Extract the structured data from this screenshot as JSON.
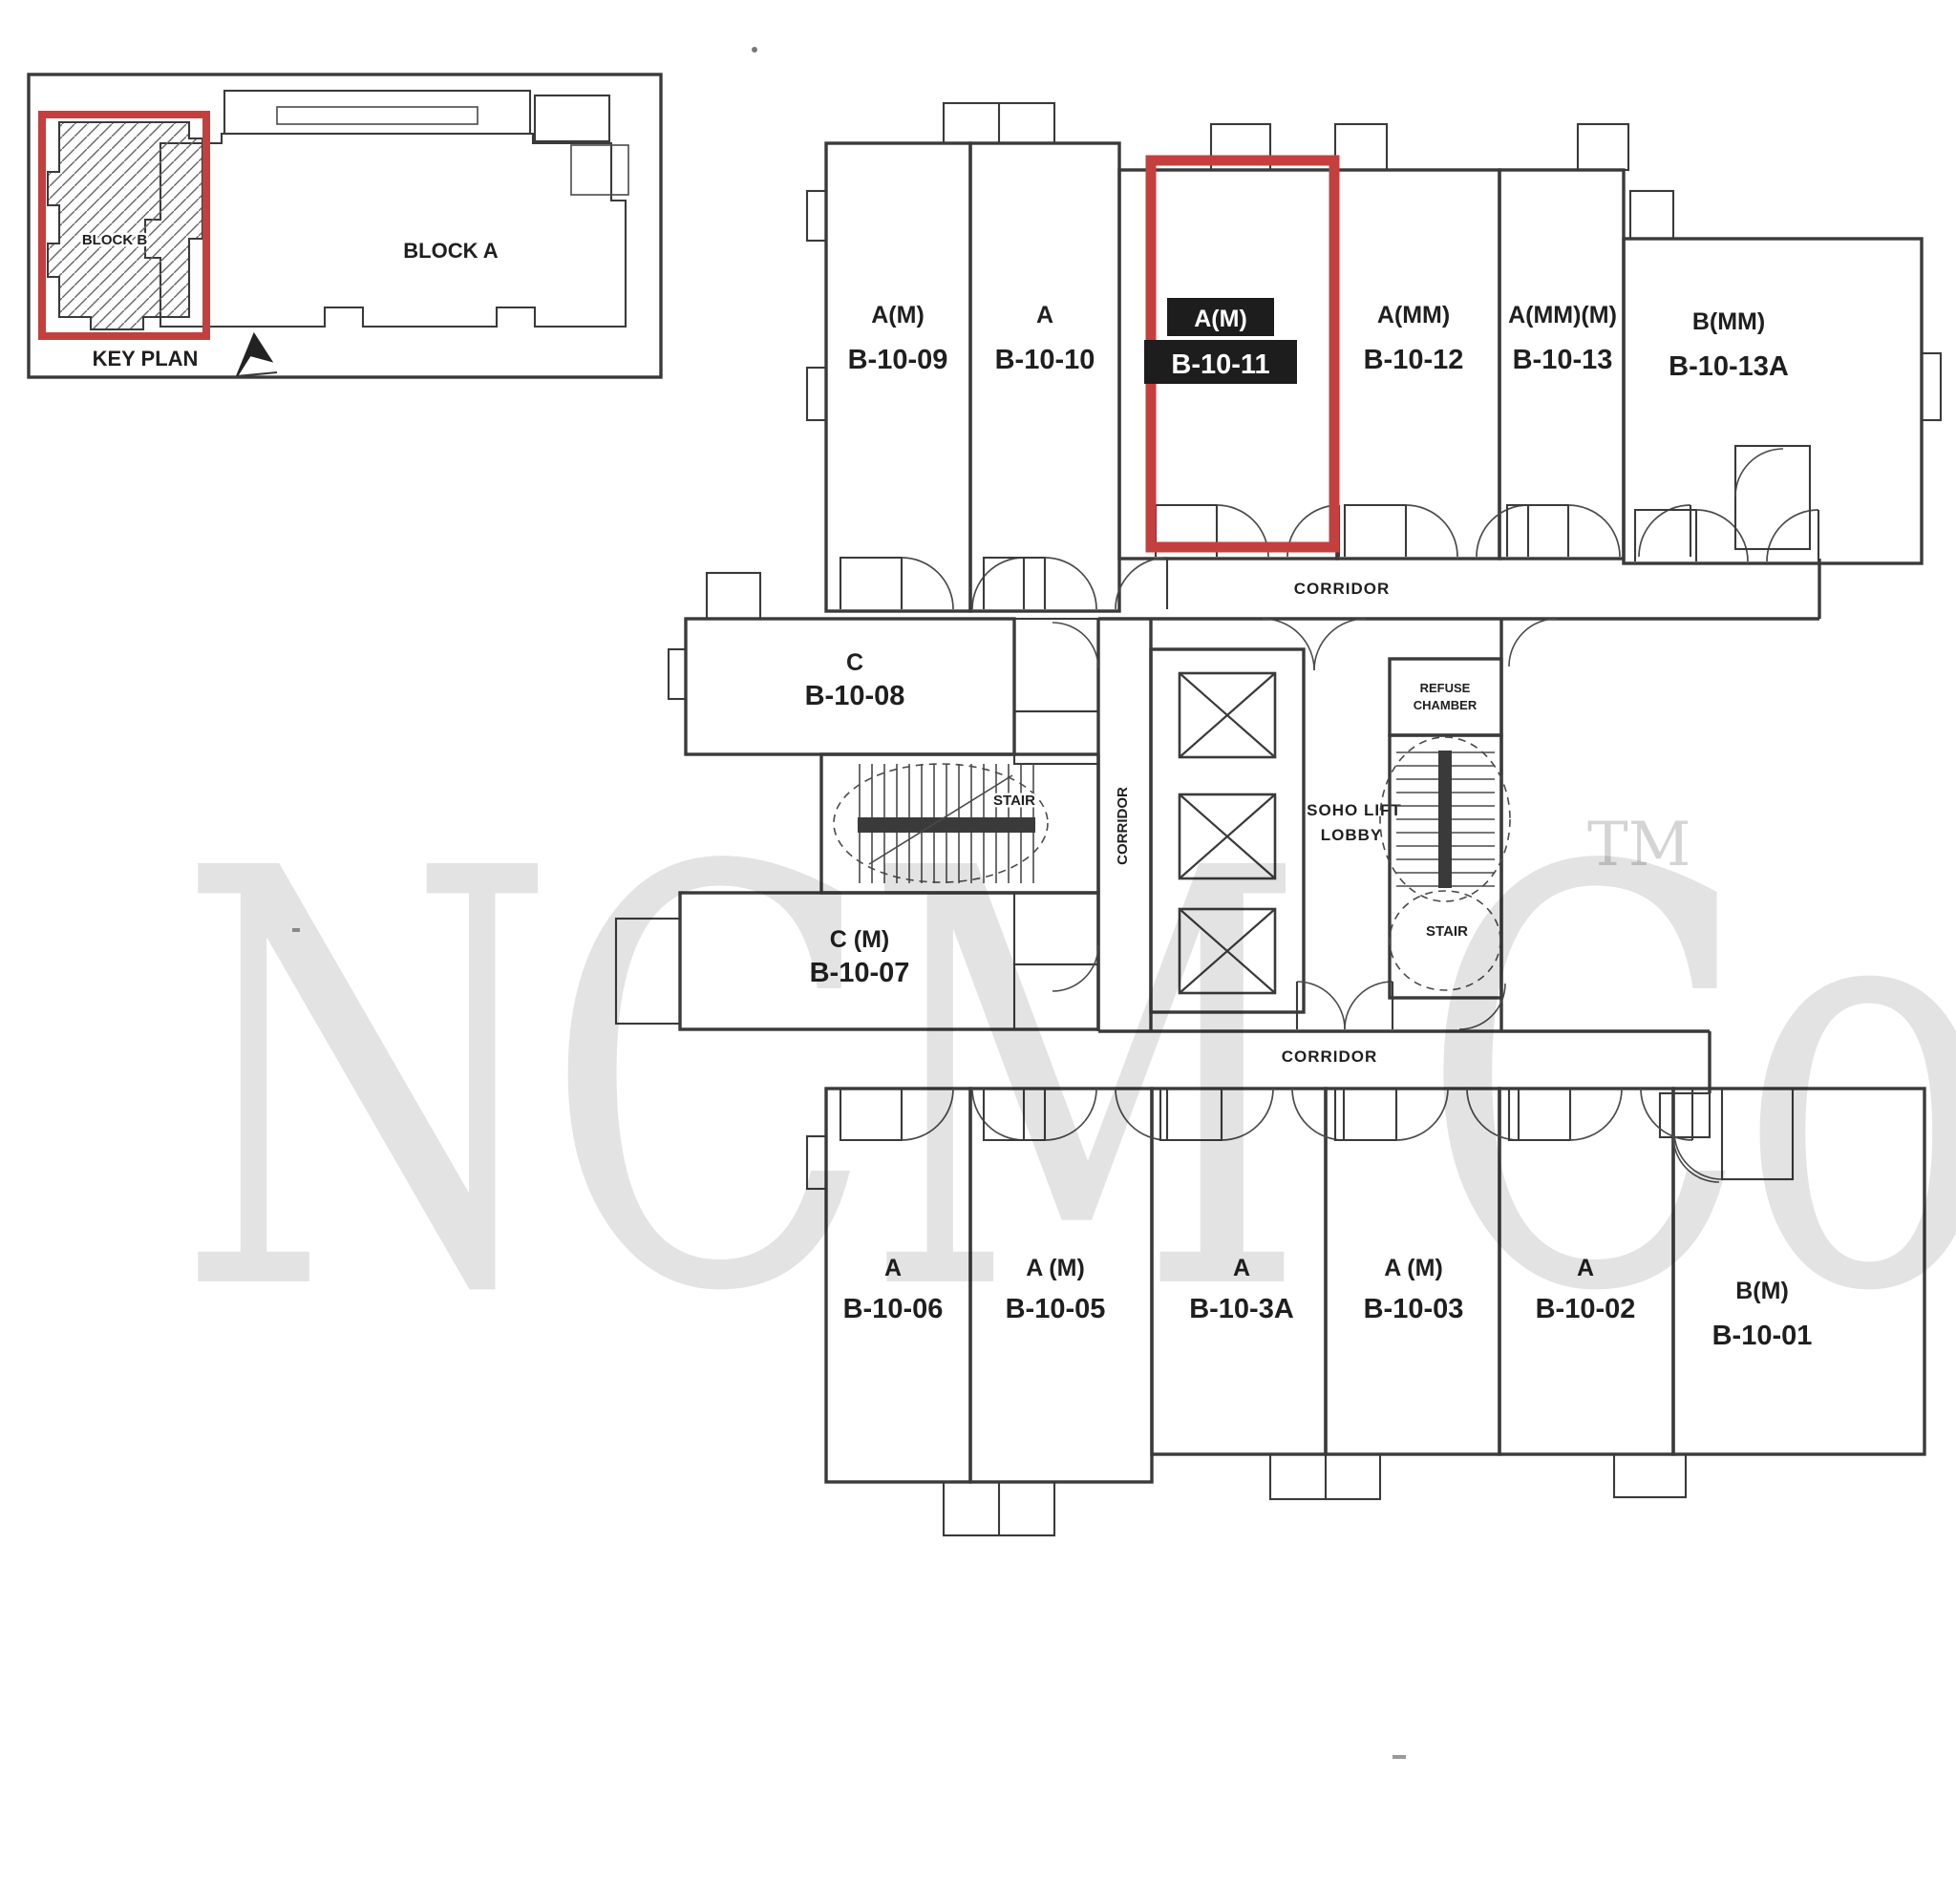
{
  "colors": {
    "wall": "#3a3a3a",
    "highlight_red": "#c4403e",
    "highlight_label_bg": "#1d1d1d",
    "watermark_gray": "#cccccc"
  },
  "key_plan": {
    "caption": "KEY PLAN",
    "block_a_label": "BLOCK A",
    "block_b_label": "BLOCK B"
  },
  "corridor_labels": {
    "top": "CORRIDOR",
    "bottom": "CORRIDOR",
    "side": "CORRIDOR"
  },
  "core_labels": {
    "lift_lobby_line1": "SOHO LIFT",
    "lift_lobby_line2": "LOBBY",
    "refuse_line1": "REFUSE",
    "refuse_line2": "CHAMBER",
    "stair_left": "STAIR",
    "stair_right": "STAIR"
  },
  "watermark": {
    "text": "NCM Co",
    "tm": "TM"
  },
  "units": {
    "top": [
      {
        "type": "A(M)",
        "number": "B-10-09",
        "highlighted": false
      },
      {
        "type": "A",
        "number": "B-10-10",
        "highlighted": false
      },
      {
        "type": "A(M)",
        "number": "B-10-11",
        "highlighted": true
      },
      {
        "type": "A(MM)",
        "number": "B-10-12",
        "highlighted": false
      },
      {
        "type": "A(MM)(M)",
        "number": "B-10-13",
        "highlighted": false
      },
      {
        "type": "B(MM)",
        "number": "B-10-13A",
        "highlighted": false
      }
    ],
    "middle": [
      {
        "type": "C",
        "number": "B-10-08",
        "highlighted": false
      },
      {
        "type": "C (M)",
        "number": "B-10-07",
        "highlighted": false
      }
    ],
    "bottom": [
      {
        "type": "A",
        "number": "B-10-06",
        "highlighted": false
      },
      {
        "type": "A (M)",
        "number": "B-10-05",
        "highlighted": false
      },
      {
        "type": "A",
        "number": "B-10-3A",
        "highlighted": false
      },
      {
        "type": "A (M)",
        "number": "B-10-03",
        "highlighted": false
      },
      {
        "type": "A",
        "number": "B-10-02",
        "highlighted": false
      },
      {
        "type": "B(M)",
        "number": "B-10-01",
        "highlighted": false
      }
    ]
  }
}
